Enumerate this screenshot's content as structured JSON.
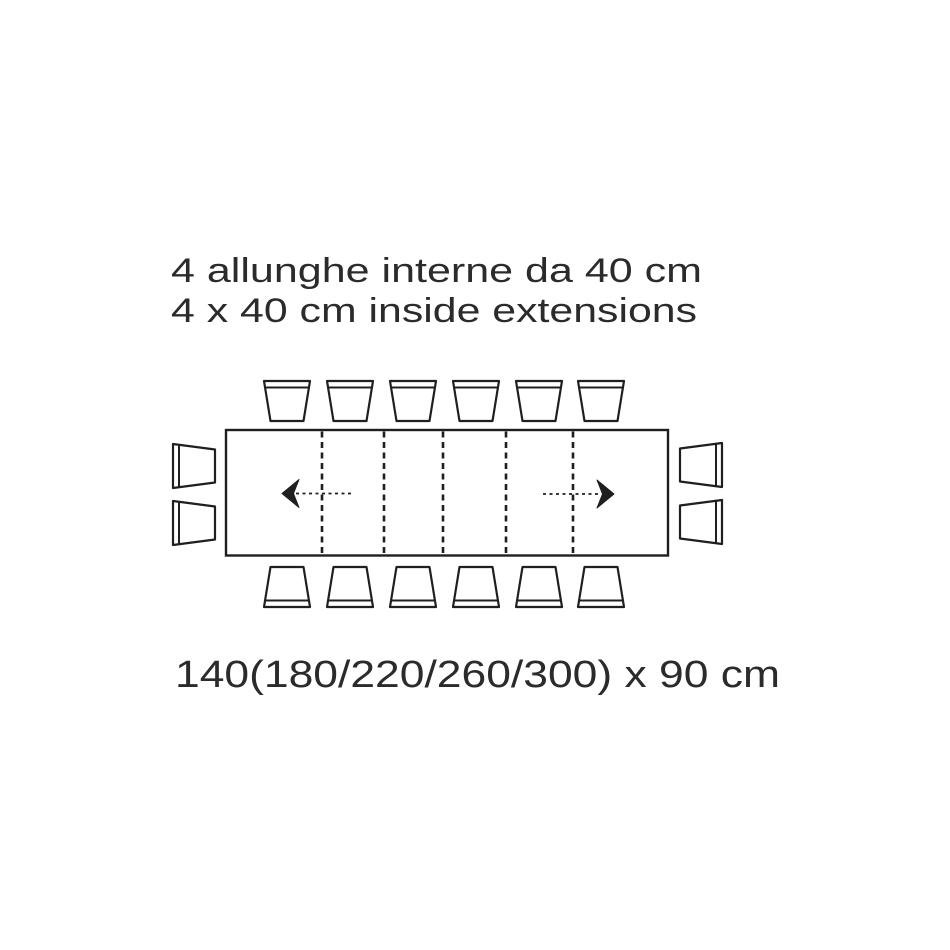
{
  "diagram": {
    "title_line1": "4 allunghe interne da 40 cm",
    "title_line2": "4 x 40 cm inside extensions",
    "dimensions_label": "140(180/220/260/300) x 90 cm",
    "colors": {
      "background": "#ffffff",
      "line": "#1f1f1f",
      "text": "#2b2b2b"
    },
    "table": {
      "closed_length_cm": 140,
      "extended_lengths_cm": [
        180,
        220,
        260,
        300
      ],
      "width_cm": 90,
      "extensions_count": 4,
      "extension_size_cm": 40
    },
    "seats": {
      "top": 6,
      "bottom": 6,
      "left": 2,
      "right": 2,
      "total": 16
    }
  }
}
